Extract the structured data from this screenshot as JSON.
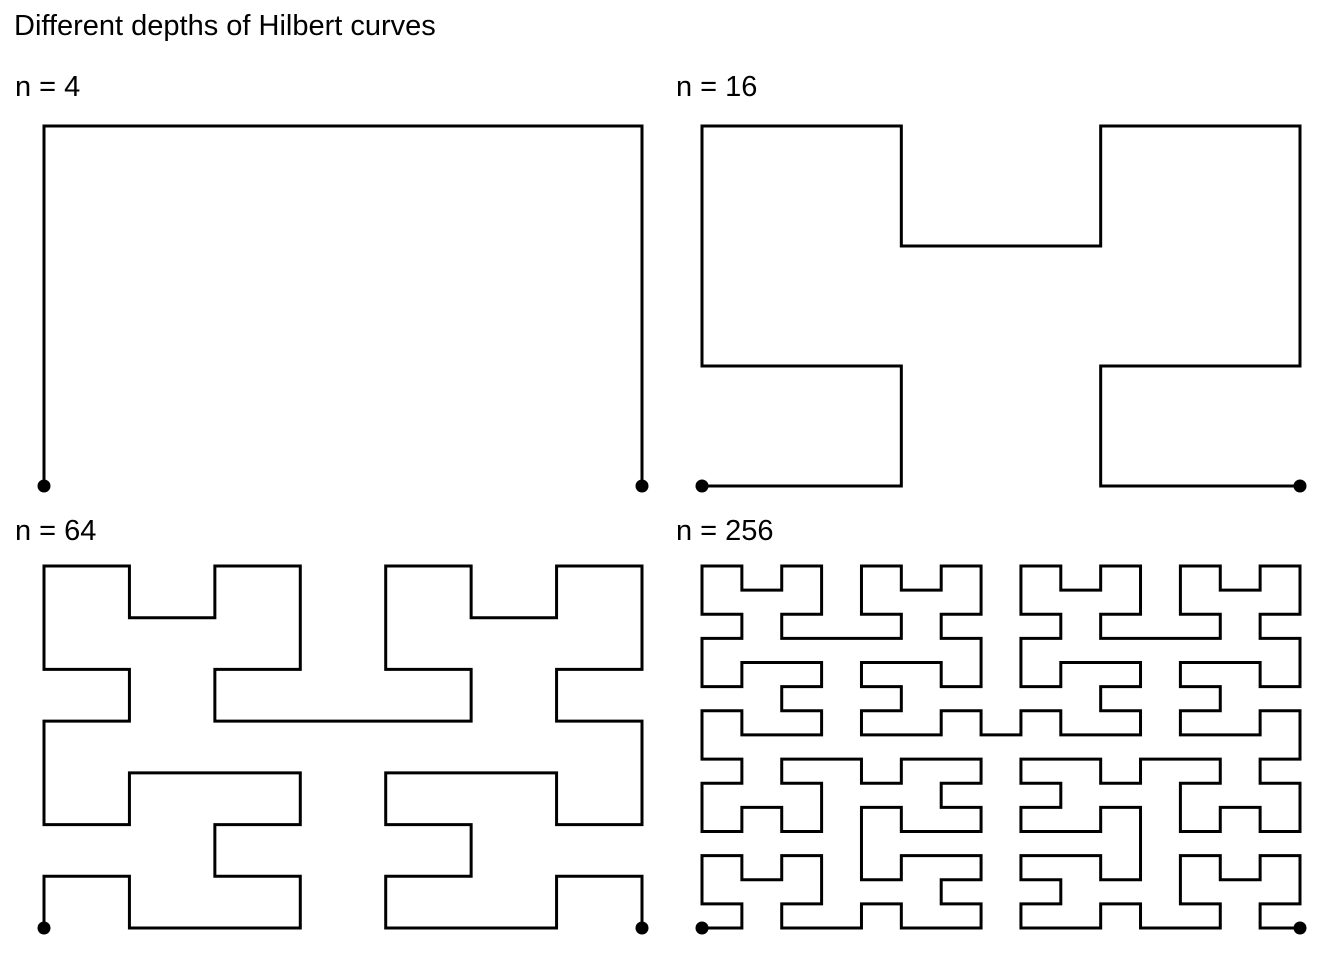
{
  "figure": {
    "title": "Different depths of Hilbert curves",
    "background_color": "#ffffff",
    "curve_color": "#000000",
    "text_color": "#000000",
    "curve_type": "hilbert",
    "panels": [
      {
        "label": "n = 4",
        "n": 4,
        "order": 1,
        "grid": "2x2",
        "start_marker": "dot",
        "end_marker": "dot",
        "start_corner": "bottom-left",
        "end_corner": "bottom-right"
      },
      {
        "label": "n = 16",
        "n": 16,
        "order": 2,
        "grid": "4x4",
        "start_marker": "dot",
        "end_marker": "dot",
        "start_corner": "bottom-left",
        "end_corner": "bottom-right"
      },
      {
        "label": "n = 64",
        "n": 64,
        "order": 3,
        "grid": "8x8",
        "start_marker": "dot",
        "end_marker": "dot",
        "start_corner": "bottom-left",
        "end_corner": "bottom-right"
      },
      {
        "label": "n = 256",
        "n": 256,
        "order": 4,
        "grid": "16x16",
        "start_marker": "dot",
        "end_marker": "dot",
        "start_corner": "bottom-left",
        "end_corner": "bottom-right"
      }
    ]
  }
}
